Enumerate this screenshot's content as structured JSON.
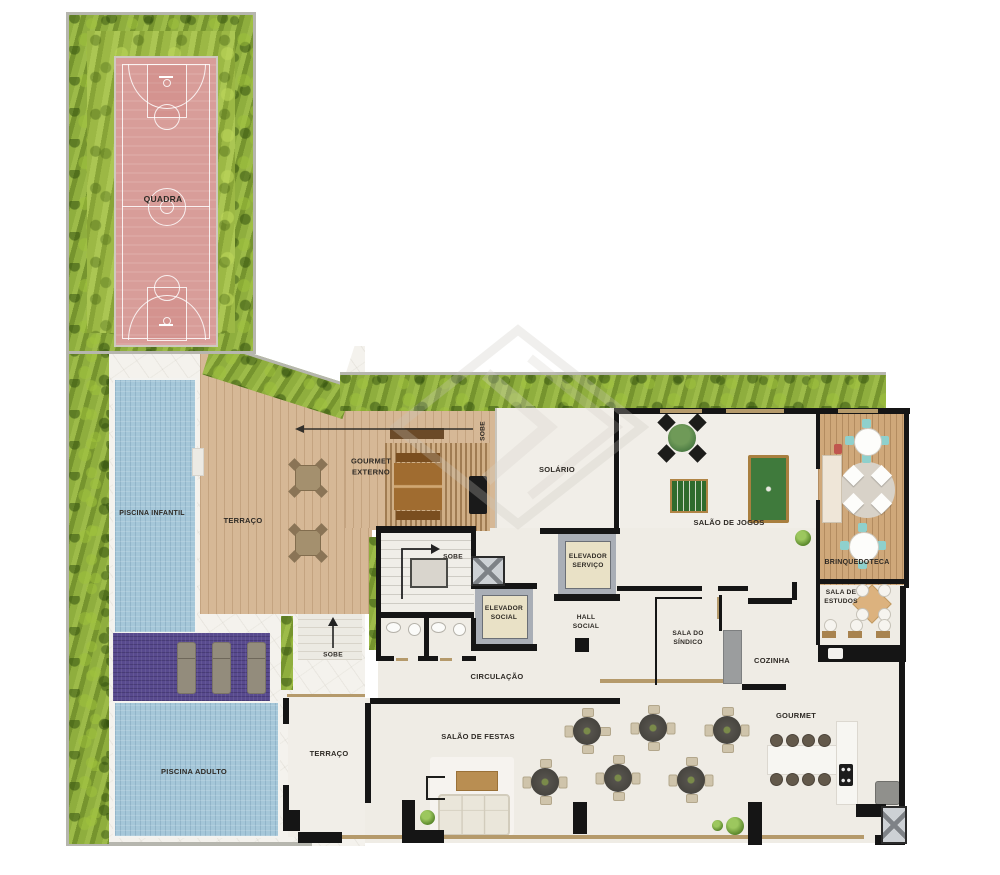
{
  "labels": {
    "quadra": "QUADRA",
    "piscina_infantil": "PISCINA INFANTIL",
    "piscina_adulto": "PISCINA ADULTO",
    "terraco_upper": "TERRAÇO",
    "terraco_lower": "TERRAÇO",
    "gourmet_externo": "GOURMET\nEXTERNO",
    "sobe_pergola": "SOBE",
    "sobe_stairs": "SOBE",
    "sobe_terrace": "SOBE",
    "solario": "SOLÁRIO",
    "salao_jogos": "SALÃO DE JOGOS",
    "brinquedoteca": "BRINQUEDOTECA",
    "sala_estudos": "SALA DE\nESTUDOS",
    "elevador_servico": "ELEVADOR\nSERVIÇO",
    "elevador_social": "ELEVADOR\nSOCIAL",
    "hall_social": "HALL\nSOCIAL",
    "circulacao": "CIRCULAÇÃO",
    "sala_sindico": "SALA DO\nSÍNDICO",
    "cozinha": "COZINHA",
    "gourmet": "GOURMET",
    "salao_festas": "SALÃO DE FESTAS"
  },
  "colors": {
    "grass": "#8fae3e",
    "hedge": "#85a236",
    "court": "#d89d99",
    "pool": "#a5c7d9",
    "purple_deck": "#584a8e",
    "deck_wood": "#d6b896",
    "room_wood": "#cfa87a",
    "indoor_floor": "#efece5",
    "marble": "#f4f2ed",
    "wall": "#151515",
    "teal_chair": "#8fd0cc"
  }
}
